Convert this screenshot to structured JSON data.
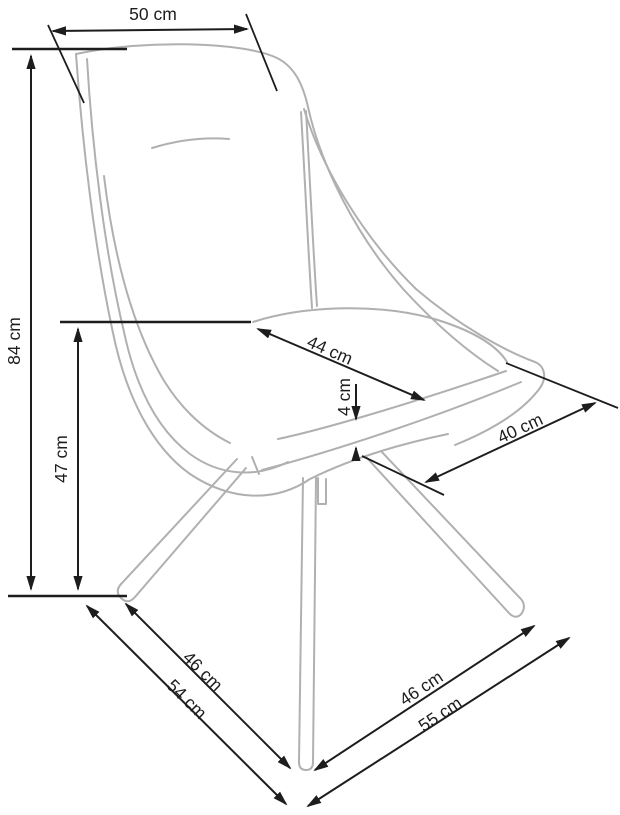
{
  "page": {
    "background": "#ffffff"
  },
  "style": {
    "dimension_color": "#1d1d1d",
    "chair_line_color": "#b0b0b0"
  },
  "diagram": {
    "type": "furniture-dimension-drawing",
    "subject": "upholstered shell chair on four splayed legs, three-quarter view",
    "unit": "cm",
    "dimensions": {
      "back_width": {
        "label": "50 cm",
        "value": 50
      },
      "overall_height": {
        "label": "84 cm",
        "value": 84
      },
      "seat_height": {
        "label": "47 cm",
        "value": 47
      },
      "seat_width": {
        "label": "44 cm",
        "value": 44
      },
      "cushion_thickness": {
        "label": "4 cm",
        "value": 4
      },
      "seat_depth": {
        "label": "40 cm",
        "value": 40
      },
      "base_span_left": {
        "label": "46 cm",
        "value": 46
      },
      "base_diag_left": {
        "label": "54 cm",
        "value": 54
      },
      "base_span_right": {
        "label": "46 cm",
        "value": 46
      },
      "base_diag_right": {
        "label": "55 cm",
        "value": 55
      }
    }
  }
}
